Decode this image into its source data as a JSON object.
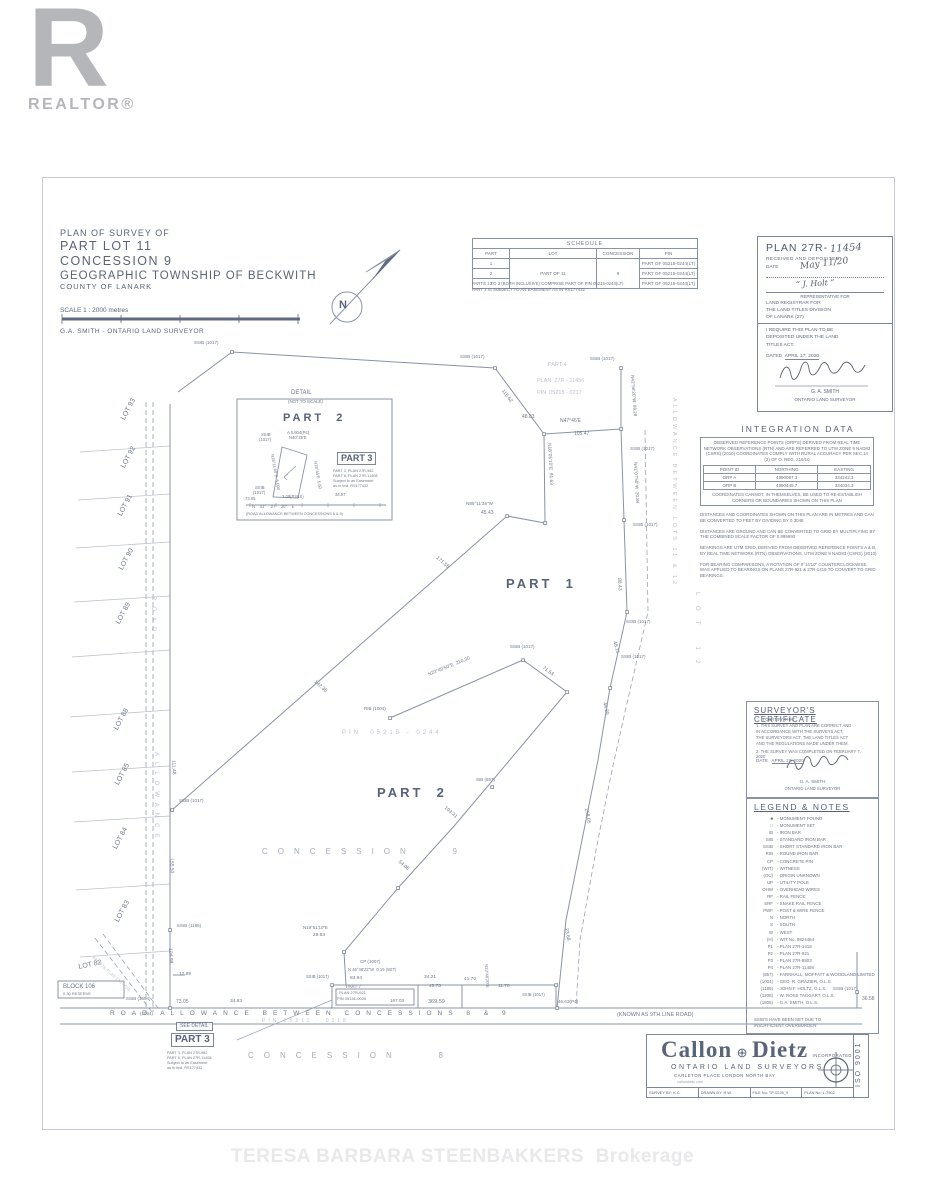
{
  "branding": {
    "realtor_r": "R",
    "realtor_word": "REALTOR®",
    "watermark": "TERESA BARBARA STEENBAKKERS  Brokerage"
  },
  "title_block": {
    "line1": "PLAN OF SURVEY OF",
    "line2": "PART LOT 11",
    "line3": "CONCESSION 9",
    "line4": "GEOGRAPHIC TOWNSHIP OF BECKWITH",
    "line5": "COUNTY OF LANARK",
    "scale": "SCALE 1 : 2000 metres",
    "surveyor": "G.A. SMITH - ONTARIO LAND SURVEYOR"
  },
  "schedule": {
    "title": "SCHEDULE",
    "columns": [
      "PART",
      "LOT",
      "CONCESSION",
      "PIN"
    ],
    "parts": [
      "1",
      "2",
      "3"
    ],
    "lot": "PART OF 11",
    "concession": "9",
    "pins": [
      "PART OF 05215-0244(LT)",
      "PART OF 05215-0244(LT)",
      "PART OF 05215-0244(LT)"
    ],
    "notes": [
      "PARTS 1 TO 3 (BOTH INCLUSIVE) COMPRISE PART OF PIN 05215-0244(LT)",
      "PART 3 IS SUBJECT TO AN EASEMENT AS IN RS177432"
    ]
  },
  "registration": {
    "plan_label": "PLAN 27R-",
    "plan_number_hw": "11454",
    "received": "RECEIVED AND DEPOSITED",
    "date_label": "DATE",
    "date_hw": "May 11/20",
    "sig1_hw": "“ J. Holt ”",
    "rep_line": "REPRESENTATIVE FOR",
    "registrar_lines": "LAND REGISTRAR FOR\nTHE LAND TITLES DIVISION\nOF LANARK (27)",
    "require_lines": "I REQUIRE THIS PLAN TO BE\nDEPOSITED UNDER THE LAND\nTITLES ACT.",
    "dated_label": "DATED",
    "dated_value": "APRIL 17, 2020",
    "name": "G. A. SMITH",
    "title": "ONTARIO LAND SURVEYOR"
  },
  "integration": {
    "title": "INTEGRATION DATA",
    "para1": "OBSERVED REFERENCE POINTS (ORP'S) DERIVED FROM REAL TIME NETWORK OBSERVATIONS (RTN) AND ARE REFERRED TO UTM ZONE 9 NAD83 (CSRS) (2010) COORDINATES COMPLY WITH RURAL ACCURACY PER SEC.14 (2) OF O. REG. 216/10",
    "table": {
      "columns": [
        "POINT ID",
        "NORTHING",
        "EASTING"
      ],
      "rows": [
        [
          "ORP A",
          "4990087.3",
          "334242.3"
        ],
        [
          "ORP B",
          "4990449.7",
          "334034.3"
        ]
      ]
    },
    "note": "COORDINATES CANNOT, IN THEMSELVES, BE USED TO RE-ESTABLISH CORNERS OR BOUNDARIES SHOWN ON THIS PLAN",
    "paras": [
      "DISTANCES AND COORDINATES SHOWN ON THIS PLAN ARE IN METRES AND CAN BE CONVERTED TO FEET BY DIVIDING BY 0.3048",
      "DISTANCES ARE GROUND AND CAN BE CONVERTED TO GRID BY MULTIPLYING BY THE COMBINED SCALE FACTOR OF 0.999990",
      "BEARINGS ARE UTM GRID, DERIVED FROM OBSERVED REFERENCE POINTS A & B, BY REAL TIME NETWORK (RTN) OBSERVATIONS, UTM ZONE 9 NAD83 (CSRS) (2010)",
      "FOR BEARING COMPARISONS, A ROTATION OF 0°14'10\" COUNTERCLOCKWISE, WAS APPLIED TO BEARINGS ON PLANS 27R-921 & 27R-1418 TO CONVERT TO GRID BEARINGS."
    ]
  },
  "certificate": {
    "title": "SURVEYOR'S CERTIFICATE",
    "intro": "I CERTIFY THAT :",
    "item1": "1. THIS SURVEY AND PLAN ARE CORRECT AND\n    IN ACCORDANCE WITH THE SURVEYS ACT,\n    THE SURVEYORS ACT, THE LAND TITLES ACT\n    AND THE REGULATIONS MADE UNDER THEM.",
    "item2": "2. THE SURVEY WAS COMPLETED ON FEBRUARY 7, 2020",
    "date_label": "DATE",
    "date_value": "APRIL 17, 2020",
    "name": "G. A. SMITH",
    "title2": "ONTARIO LAND SURVEYOR"
  },
  "legend": {
    "title": "LEGEND & NOTES",
    "items": [
      [
        "■",
        "- MONUMENT FOUND"
      ],
      [
        "□",
        "- MONUMENT SET"
      ],
      [
        "IB",
        "- IRON BAR"
      ],
      [
        "SIB",
        "- STANDARD IRON BAR"
      ],
      [
        "SSIB",
        "- SHORT STANDARD IRON BAR"
      ],
      [
        "RIB",
        "- ROUND IRON BAR"
      ],
      [
        "CP",
        "- CONCRETE PIN"
      ],
      [
        "(WIT)",
        "- WITNESS"
      ],
      [
        "(OU)",
        "- ORIGIN UNKNOWN"
      ],
      [
        "UP",
        "- UTILITY POLE"
      ],
      [
        "OHW",
        "- OVERHEAD WIRES"
      ],
      [
        "RF",
        "- RAIL FENCE"
      ],
      [
        "SRF",
        "- SNAKE RAIL FENCE"
      ],
      [
        "PWF",
        "- POST & WIRE FENCE"
      ],
      [
        "N",
        "- NORTH"
      ],
      [
        "S",
        "- SOUTH"
      ],
      [
        "W",
        "- WEST"
      ],
      [
        "(H)",
        "- WIT No. 9824484"
      ],
      [
        "P1",
        "- PLAN 27R-1418"
      ],
      [
        "P2",
        "- PLAN 27R-921"
      ],
      [
        "P3",
        "- PLAN 27R-8803"
      ],
      [
        "P4",
        "- PLAN 27R-11408"
      ],
      [
        "(857)",
        "- FARNHALL, MOFFATT & WOODLAND LIMITED"
      ],
      [
        "(1004)",
        "- GEO. R. GRAZIER, O.L.S."
      ],
      [
        "(1185)",
        "- JOHN F. HOLTZ, O.L.S."
      ],
      [
        "(1208)",
        "- W. ROSS TAGGART, O.L.S."
      ],
      [
        "(1805)",
        "- G.A. SMITH, O.L.S."
      ]
    ],
    "note": "SSIB'S HAVE BEEN SET DUE TO\nINSUFFICIENT OVERBURDEN"
  },
  "firm": {
    "name1": "Callon",
    "sep": "⊕",
    "name2": "Dietz",
    "incorporated": "INCORPORATED",
    "line1": "ONTARIO LAND SURVEYORS",
    "line2": "CARLETON PLACE    LONDON    NORTH BAY",
    "line3": "callondietz.com",
    "cells": [
      "SURVEY BY: K.C.",
      "DRAWN BY: R.W.",
      "FILE No: TP-0225_9",
      "PLAN No: L-7502"
    ],
    "iso": "ISO 9001"
  },
  "draw": {
    "labels": [
      {
        "t": "LOT 93",
        "x": 120,
        "y": 418,
        "r": -62,
        "s": 7
      },
      {
        "t": "LOT 92",
        "x": 120,
        "y": 466,
        "r": -62,
        "s": 7
      },
      {
        "t": "LOT 91",
        "x": 117,
        "y": 514,
        "r": -62,
        "s": 7
      },
      {
        "t": "LOT 90",
        "x": 118,
        "y": 568,
        "r": -62,
        "s": 7
      },
      {
        "t": "LOT 89",
        "x": 115,
        "y": 622,
        "r": -62,
        "s": 7
      },
      {
        "t": "LOT 88",
        "x": 113,
        "y": 728,
        "r": -62,
        "s": 7
      },
      {
        "t": "LOT 85",
        "x": 114,
        "y": 783,
        "r": -62,
        "s": 7
      },
      {
        "t": "LOT 84",
        "x": 112,
        "y": 847,
        "r": -62,
        "s": 7
      },
      {
        "t": "LOT 83",
        "x": 114,
        "y": 920,
        "r": -62,
        "s": 7
      },
      {
        "t": "LOT 82",
        "x": 78,
        "y": 964,
        "r": -12,
        "s": 7
      },
      {
        "t": "ROAD",
        "x": 156,
        "y": 596,
        "r": 90,
        "s": 6,
        "c": "f sp2"
      },
      {
        "t": "ALLOWANCE",
        "x": 159,
        "y": 752,
        "r": 90,
        "s": 6,
        "c": "f sp2"
      },
      {
        "t": "PIN  05215 - 0244",
        "x": 342,
        "y": 730,
        "s": 6,
        "c": "f sp1"
      },
      {
        "t": "PART  1",
        "x": 506,
        "y": 577,
        "s": 13,
        "c": "d sp1"
      },
      {
        "t": "PART  2",
        "x": 377,
        "y": 786,
        "s": 13,
        "c": "d sp1"
      },
      {
        "t": "CONCESSION   9",
        "x": 262,
        "y": 848,
        "s": 8,
        "c": "lt sp3"
      },
      {
        "t": "CONCESSION   8",
        "x": 248,
        "y": 1052,
        "s": 8,
        "c": "lt sp3"
      },
      {
        "t": "ROAD ALLOWANCE BETWEEN CONCESSIONS 8 & 9",
        "x": 110,
        "y": 1011,
        "s": 6.5,
        "c": "sp2"
      },
      {
        "t": "(KNOWN AS 9TH LINE ROAD)",
        "x": 617,
        "y": 1013,
        "s": 5.5
      },
      {
        "t": "PIN 05211 - 0218",
        "x": 262,
        "y": 1019,
        "s": 5,
        "c": "f sp1"
      },
      {
        "t": "PART 4",
        "x": 548,
        "y": 363,
        "s": 5.5,
        "c": "f"
      },
      {
        "t": "PLAN  27R - 11456",
        "x": 537,
        "y": 379,
        "s": 5.5,
        "c": "f"
      },
      {
        "t": "PIN  05215 - 0217",
        "x": 537,
        "y": 391,
        "s": 5.5,
        "c": "f"
      },
      {
        "t": "N47°46'E",
        "x": 560,
        "y": 419,
        "s": 5
      },
      {
        "t": "105.47",
        "x": 574,
        "y": 432,
        "s": 5
      },
      {
        "t": "48.83",
        "x": 522,
        "y": 415,
        "s": 5
      },
      {
        "t": "116.62",
        "x": 504,
        "y": 389,
        "r": 53,
        "s": 5
      },
      {
        "t": "N18°05'10\"E  91.63",
        "x": 550,
        "y": 443,
        "r": 87,
        "s": 4.8
      },
      {
        "t": "N85°11'35\"W",
        "x": 466,
        "y": 502,
        "s": 4.6
      },
      {
        "t": "45.43",
        "x": 481,
        "y": 511,
        "s": 5
      },
      {
        "t": "171.55",
        "x": 438,
        "y": 556,
        "r": 41,
        "s": 5
      },
      {
        "t": "142.36",
        "x": 316,
        "y": 680,
        "r": 41,
        "s": 5
      },
      {
        "t": "SSIB (1017)",
        "x": 460,
        "y": 355,
        "s": 4.5
      },
      {
        "t": "SSIB (1017)",
        "x": 194,
        "y": 341,
        "s": 4.5
      },
      {
        "t": "SSIB (1017)",
        "x": 590,
        "y": 357,
        "s": 4.5
      },
      {
        "t": "N42°56'20\"W  88.28",
        "x": 634,
        "y": 375,
        "r": 86,
        "s": 4.6
      },
      {
        "t": "SSIB (1017)",
        "x": 630,
        "y": 447,
        "s": 4.5
      },
      {
        "t": "N41°07'50\"W  20.84",
        "x": 637,
        "y": 462,
        "r": 87,
        "s": 4.6
      },
      {
        "t": "SSIB (1017)",
        "x": 633,
        "y": 523,
        "s": 4.5
      },
      {
        "t": "88.43",
        "x": 621,
        "y": 578,
        "r": 88,
        "s": 5
      },
      {
        "t": "SSIB (1017)",
        "x": 626,
        "y": 620,
        "s": 4.5
      },
      {
        "t": "48.11",
        "x": 616,
        "y": 641,
        "r": 72,
        "s": 5
      },
      {
        "t": "SSIB (1017)",
        "x": 621,
        "y": 655,
        "s": 4.5
      },
      {
        "t": "44.20",
        "x": 606,
        "y": 702,
        "r": 76,
        "s": 5
      },
      {
        "t": "258.05",
        "x": 588,
        "y": 808,
        "r": 80,
        "s": 5
      },
      {
        "t": "23.68",
        "x": 568,
        "y": 928,
        "r": 80,
        "s": 5
      },
      {
        "t": "369.59",
        "x": 428,
        "y": 1000,
        "s": 5.5
      },
      {
        "t": "46.63(P4)",
        "x": 558,
        "y": 1000,
        "s": 4.6
      },
      {
        "t": "36.58",
        "x": 862,
        "y": 997,
        "s": 5
      },
      {
        "t": "SSIB (1017)",
        "x": 833,
        "y": 987,
        "s": 4.5
      },
      {
        "t": "73.05",
        "x": 176,
        "y": 1000,
        "s": 5
      },
      {
        "t": "34.83",
        "x": 230,
        "y": 1000,
        "s": 4.8
      },
      {
        "t": "12.89",
        "x": 179,
        "y": 973,
        "s": 4.8
      },
      {
        "t": "111.48",
        "x": 175,
        "y": 760,
        "r": 87,
        "s": 5
      },
      {
        "t": "SSIB (1017)",
        "x": 179,
        "y": 799,
        "s": 4.5
      },
      {
        "t": "155.50",
        "x": 173,
        "y": 858,
        "r": 87,
        "s": 5
      },
      {
        "t": "SSIB (1185)",
        "x": 177,
        "y": 924,
        "s": 4.5
      },
      {
        "t": "104.98",
        "x": 172,
        "y": 948,
        "r": 87,
        "s": 5
      },
      {
        "t": "SSIB (1694)",
        "x": 126,
        "y": 997,
        "s": 4.5
      },
      {
        "t": "(1094)",
        "x": 140,
        "y": 1012,
        "s": 4.5
      },
      {
        "t": "RIB (1004)",
        "x": 364,
        "y": 707,
        "s": 4.5
      },
      {
        "t": "N23°40'50\"E  210.30",
        "x": 428,
        "y": 674,
        "r": -22,
        "s": 4.8
      },
      {
        "t": "SSIB (1017)",
        "x": 510,
        "y": 645,
        "s": 4.5
      },
      {
        "t": "71.53",
        "x": 544,
        "y": 666,
        "r": 36,
        "s": 5
      },
      {
        "t": "193.31",
        "x": 446,
        "y": 806,
        "r": 40,
        "s": 5
      },
      {
        "t": "SIB (857)",
        "x": 476,
        "y": 778,
        "s": 4.5
      },
      {
        "t": "54.06",
        "x": 400,
        "y": 860,
        "r": 40,
        "s": 5
      },
      {
        "t": "N19°51'10\"E",
        "x": 303,
        "y": 926,
        "s": 4.4
      },
      {
        "t": "28.63",
        "x": 313,
        "y": 934,
        "s": 4.8
      },
      {
        "t": "CP (1007)",
        "x": 360,
        "y": 960,
        "s": 4.5
      },
      {
        "t": "N 46°48'22\"W  0.15 (WIT)",
        "x": 348,
        "y": 968,
        "s": 4.2
      },
      {
        "t": "83.94",
        "x": 350,
        "y": 977,
        "s": 4.8
      },
      {
        "t": "34.21",
        "x": 424,
        "y": 976,
        "s": 4.8
      },
      {
        "t": "45.73",
        "x": 429,
        "y": 985,
        "s": 4.8
      },
      {
        "t": "41.70",
        "x": 464,
        "y": 978,
        "s": 4.8
      },
      {
        "t": "11.70",
        "x": 498,
        "y": 985,
        "s": 4.8
      },
      {
        "t": "167.03",
        "x": 390,
        "y": 999,
        "s": 4.6
      },
      {
        "t": "PART 7",
        "x": 346,
        "y": 985,
        "s": 4.4
      },
      {
        "t": "PLAN 27R-921",
        "x": 339,
        "y": 991,
        "s": 4
      },
      {
        "t": "PIN 05151-0005",
        "x": 337,
        "y": 997,
        "s": 4
      },
      {
        "t": "SSIB (1017)",
        "x": 306,
        "y": 975,
        "s": 4.2
      },
      {
        "t": "SSIB (1017)",
        "x": 522,
        "y": 993,
        "s": 4.2
      },
      {
        "t": "N13°46'20\"E",
        "x": 488,
        "y": 964,
        "r": 87,
        "s": 4.2
      },
      {
        "t": "LOT 12",
        "x": 700,
        "y": 592,
        "r": 90,
        "s": 6.5,
        "c": "f sp3"
      },
      {
        "t": "ALLOWANCE BETWEEN LOTS 11 & 12",
        "x": 676,
        "y": 398,
        "r": 90,
        "s": 5.5,
        "c": "f sp1"
      },
      {
        "t": "PART 73, PLAN 27R-4033",
        "x": 94,
        "y": 956,
        "r": 42,
        "s": 4.2,
        "c": "f"
      },
      {
        "t": "N",
        "x": 339,
        "y": 300,
        "s": 11,
        "c": "d"
      },
      {
        "t": "DETAIL",
        "x": 291,
        "y": 390,
        "s": 6
      },
      {
        "t": "(NOT TO SCALE)",
        "x": 288,
        "y": 400,
        "s": 4.4
      },
      {
        "t": "PART  2",
        "x": 283,
        "y": 413,
        "s": 11,
        "c": "d sp1"
      },
      {
        "t": "SSIB",
        "x": 261,
        "y": 433,
        "s": 4.2
      },
      {
        "t": "(1017)",
        "x": 259,
        "y": 438,
        "s": 4.2
      },
      {
        "t": "A 0.904(P4)",
        "x": 287,
        "y": 431,
        "s": 4.2
      },
      {
        "t": "N40°25'E",
        "x": 289,
        "y": 436,
        "s": 4.2
      },
      {
        "t": "N16°11'40\"E  5.693",
        "x": 274,
        "y": 454,
        "r": 80,
        "s": 4.2
      },
      {
        "t": "N18°45'E  5.60",
        "x": 317,
        "y": 461,
        "r": 80,
        "s": 4.2
      },
      {
        "t": "SSIB",
        "x": 255,
        "y": 486,
        "s": 4.2
      },
      {
        "t": "(1017)",
        "x": 253,
        "y": 491,
        "s": 4.2
      },
      {
        "t": "73.05",
        "x": 245,
        "y": 497,
        "s": 4.2
      },
      {
        "t": "3.09(P2&S)",
        "x": 282,
        "y": 495,
        "s": 4.2
      },
      {
        "t": "34.97",
        "x": 335,
        "y": 493,
        "s": 4.2
      },
      {
        "t": "N    43°    27'    30\"    E",
        "x": 252,
        "y": 505,
        "s": 4.2
      },
      {
        "t": "(ROAD ALLOWANCE BETWEEN CONCESSIONS 8 & 9)",
        "x": 246,
        "y": 513,
        "s": 3.8
      },
      {
        "t": "PART 3",
        "x": 337,
        "y": 452,
        "s": 9,
        "c": "d box"
      },
      {
        "t": "PART 3, PLAN 27R-982",
        "x": 333,
        "y": 470,
        "s": 3.8
      },
      {
        "t": "PART 6, PLAN 27R-11408",
        "x": 333,
        "y": 475,
        "s": 3.8
      },
      {
        "t": "Subject to an Easement",
        "x": 333,
        "y": 480,
        "s": 3.8
      },
      {
        "t": "as in Inst. RS177432",
        "x": 333,
        "y": 485,
        "s": 3.8
      },
      {
        "t": "SEE DETAIL",
        "x": 176,
        "y": 1022,
        "s": 5,
        "c": "box"
      },
      {
        "t": "PART 3",
        "x": 171,
        "y": 1033,
        "s": 10,
        "c": "d box"
      },
      {
        "t": "PART 3, PLAN 27R-982",
        "x": 167,
        "y": 1052,
        "s": 3.8
      },
      {
        "t": "PART 6, PLAN 27R-11408",
        "x": 167,
        "y": 1057,
        "s": 3.8
      },
      {
        "t": "Subject to an Easement",
        "x": 167,
        "y": 1062,
        "s": 3.8
      },
      {
        "t": "as in Inst. RS177432",
        "x": 167,
        "y": 1067,
        "s": 3.8
      },
      {
        "t": "BLOCK 106",
        "x": 63,
        "y": 984,
        "s": 6
      },
      {
        "t": "0.30 RESERVE",
        "x": 63,
        "y": 992,
        "s": 4
      }
    ]
  }
}
